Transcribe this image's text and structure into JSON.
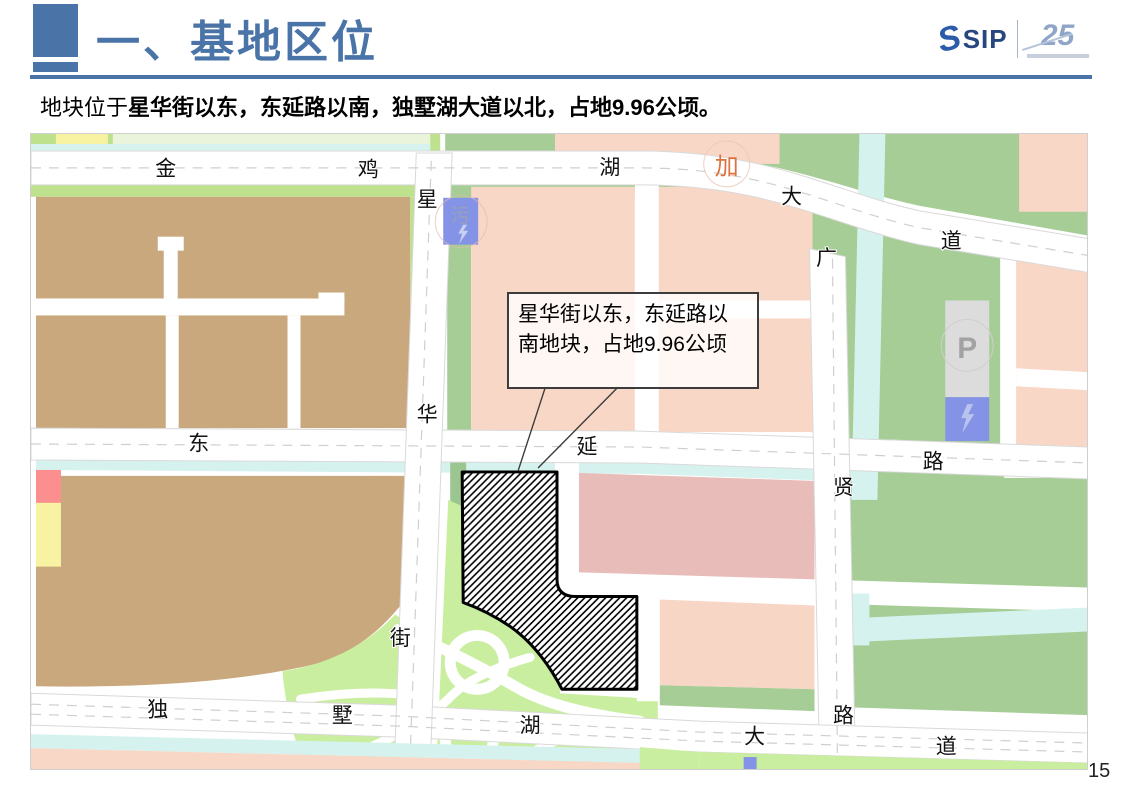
{
  "slide": {
    "title": "一、基地区位",
    "subtitle_prefix": "地块位于",
    "subtitle_bold": "星华街以东，东延路以南，独墅湖大道以北，占地9.96公顷。",
    "page_number": "15"
  },
  "logo": {
    "brand": "SIP",
    "anniversary": "25"
  },
  "map": {
    "callout_text": "星华街以东，东延路以南地块，占地9.96公顷",
    "road_labels": [
      {
        "ch": "金",
        "x": 165,
        "y": 168
      },
      {
        "ch": "鸡",
        "x": 368,
        "y": 169
      },
      {
        "ch": "湖",
        "x": 610,
        "y": 167
      },
      {
        "ch": "大",
        "x": 792,
        "y": 196
      },
      {
        "ch": "道",
        "x": 952,
        "y": 241
      },
      {
        "ch": "星",
        "x": 427,
        "y": 199
      },
      {
        "ch": "华",
        "x": 427,
        "y": 415
      },
      {
        "ch": "街",
        "x": 400,
        "y": 639
      },
      {
        "ch": "东",
        "x": 198,
        "y": 444
      },
      {
        "ch": "延",
        "x": 587,
        "y": 447
      },
      {
        "ch": "路",
        "x": 934,
        "y": 462
      },
      {
        "ch": "广",
        "x": 827,
        "y": 258
      },
      {
        "ch": "贤",
        "x": 844,
        "y": 488
      },
      {
        "ch": "路",
        "x": 844,
        "y": 717
      },
      {
        "ch": "独",
        "x": 157,
        "y": 711
      },
      {
        "ch": "墅",
        "x": 342,
        "y": 717
      },
      {
        "ch": "湖",
        "x": 530,
        "y": 727
      },
      {
        "ch": "大",
        "x": 755,
        "y": 738
      },
      {
        "ch": "道",
        "x": 947,
        "y": 748
      }
    ],
    "markers": [
      {
        "ch": "污",
        "x": 460,
        "y": 216,
        "cls": "m-util"
      },
      {
        "ch": "加",
        "x": 727,
        "y": 166,
        "cls": "m-gas"
      },
      {
        "ch": "P",
        "x": 968,
        "y": 348,
        "cls": "m-park"
      }
    ],
    "colors": {
      "road": "#ffffff",
      "parcel_brown": "#c9a87d",
      "parcel_pink": "#f9d7c7",
      "parcel_pink_dark": "#e8bcb8",
      "green_verge": "#bee18e",
      "green_block": "#a6cd96",
      "green_park": "#c9ee9f",
      "canal": "#d6f2ee",
      "utility_blue": "#8593e6",
      "parking_gray": "#dcdcdc",
      "yellow_parcel": "#f7f3a2",
      "red_parcel": "#fb8f8f",
      "site_outline": "#000000",
      "accent_blue": "#4a74a8"
    }
  }
}
